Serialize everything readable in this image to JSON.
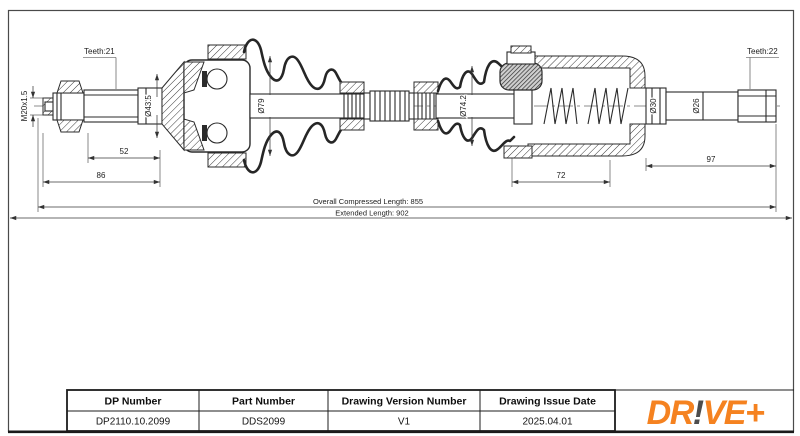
{
  "dimensions": {
    "teeth_left": "Teeth:21",
    "teeth_right": "Teeth:22",
    "thread_spec": "M20x1.5",
    "outer_joint_dia": "Ø43.5",
    "left_boot_dia": "Ø79",
    "right_boot_dia": "Ø74.2",
    "collar_dia": "Ø30",
    "stub_shaft_dia": "Ø26",
    "spline_section_length": "52",
    "outer_end_length": "86",
    "inner_joint_length": "72",
    "stub_shaft_length": "97",
    "overall_compressed_length": "Overall  Compressed  Length: 855",
    "extended_length": "Extended  Length: 902"
  },
  "title_block": {
    "headers": [
      "DP Number",
      "Part Number",
      "Drawing Version Number",
      "Drawing Issue Date"
    ],
    "values": [
      "DP2110.10.2099",
      "DDS2099",
      "V1",
      "2025.04.01"
    ]
  },
  "logo": {
    "dr": "DR",
    "bang": "!",
    "ve": "VE",
    "plus": "+"
  },
  "colors": {
    "logo_orange": "#F58220",
    "logo_dark": "#4D4D4D",
    "line": "#2B2B2B"
  }
}
